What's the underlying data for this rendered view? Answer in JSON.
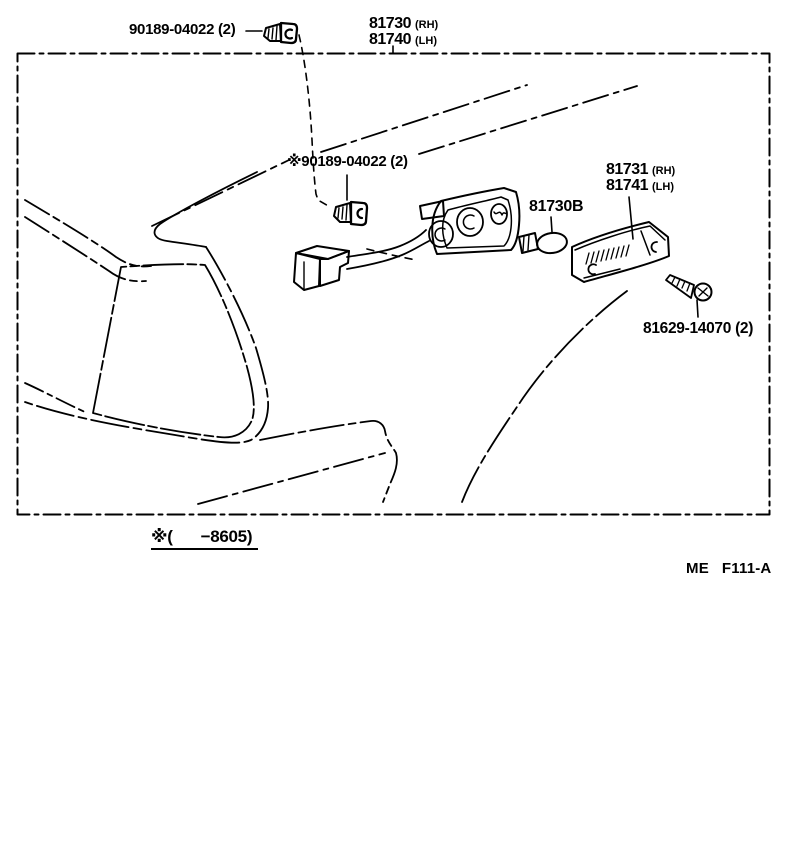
{
  "page": {
    "background_color": "#ffffff",
    "ink_color": "#000000",
    "type": "parts-catalog-figure"
  },
  "labels": {
    "clip_top": {
      "text": "90189-04022 (2)"
    },
    "clip_inner": {
      "text": "※90189-04022 (2)"
    },
    "lamp_assy": {
      "rh": "81730",
      "rh_side": "(RH)",
      "lh": "81740",
      "lh_side": "(LH)"
    },
    "lens": {
      "rh": "81731",
      "rh_side": "(RH)",
      "lh": "81741",
      "lh_side": "(LH)"
    },
    "bulb": {
      "text": "81730B"
    },
    "screw": {
      "text": "81629-14070 (2)"
    }
  },
  "footnote": {
    "prefix": "※(",
    "value": "−8605)"
  },
  "figure_ref": {
    "org": "ME",
    "code": "F111-A"
  },
  "parts_depicted": [
    {
      "name": "fastener-clip-top",
      "label": "90189-04022 (2)"
    },
    {
      "name": "fastener-clip-inner",
      "label": "※90189-04022 (2)"
    },
    {
      "name": "side-turn-signal-lamp-housing",
      "label": "81730 (RH) / 81740 (LH)"
    },
    {
      "name": "wire-connector-and-harness",
      "label": ""
    },
    {
      "name": "bulb",
      "label": "81730B"
    },
    {
      "name": "lens-body",
      "label": "81731 (RH) / 81741 (LH)"
    },
    {
      "name": "screw",
      "label": "81629-14070 (2)"
    }
  ]
}
